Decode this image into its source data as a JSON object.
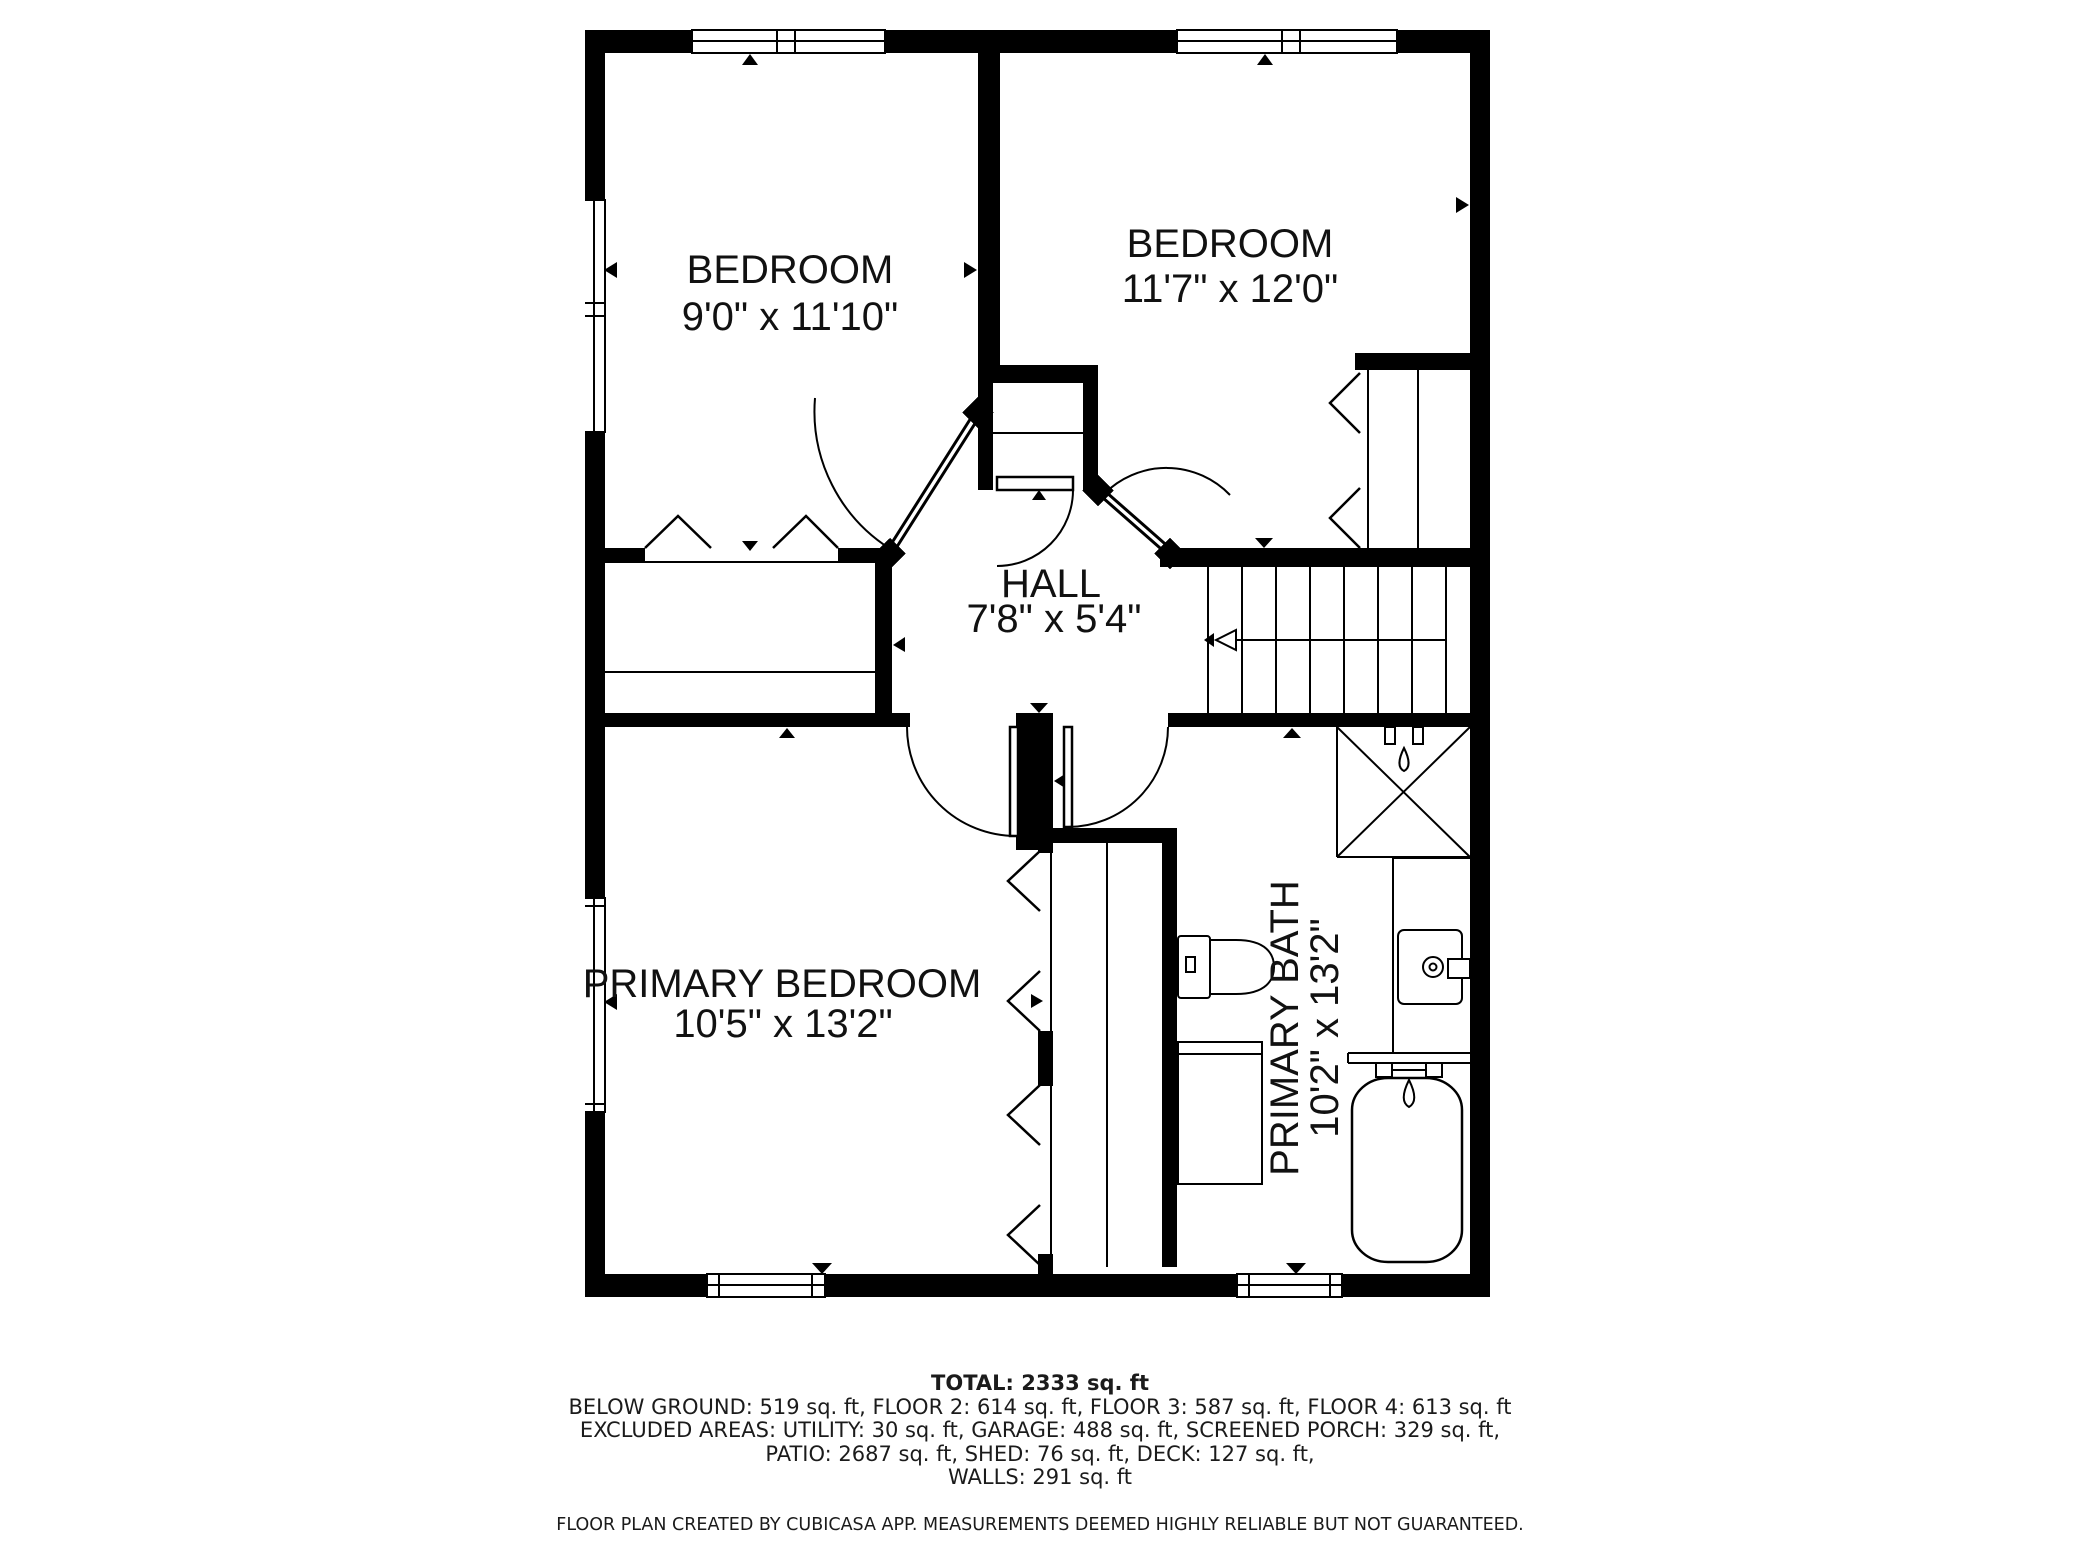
{
  "rooms": [
    {
      "name": "BEDROOM",
      "dims": "9'0\" x 11'10\""
    },
    {
      "name": "BEDROOM",
      "dims": "11'7\" x 12'0\""
    },
    {
      "name": "HALL",
      "dims": "7'8\" x 5'4\""
    },
    {
      "name": "PRIMARY BEDROOM",
      "dims": "10'5\" x 13'2\""
    },
    {
      "name": "PRIMARY BATH",
      "dims": "10'2\" x 13'2\""
    }
  ],
  "summary": {
    "total": "TOTAL: 2333 sq. ft",
    "line1": "BELOW GROUND: 519 sq. ft, FLOOR 2: 614 sq. ft, FLOOR 3: 587 sq. ft, FLOOR 4: 613 sq. ft",
    "line2": "EXCLUDED AREAS: UTILITY: 30 sq. ft, GARAGE: 488 sq. ft, SCREENED PORCH: 329 sq. ft,",
    "line3": "PATIO: 2687 sq. ft, SHED: 76 sq. ft, DECK: 127 sq. ft,",
    "line4": "WALLS: 291 sq. ft",
    "disclaimer": "FLOOR PLAN CREATED BY CUBICASA APP. MEASUREMENTS DEEMED HIGHLY RELIABLE BUT NOT GUARANTEED."
  },
  "colors": {
    "wall": "#000000",
    "background": "#ffffff"
  }
}
